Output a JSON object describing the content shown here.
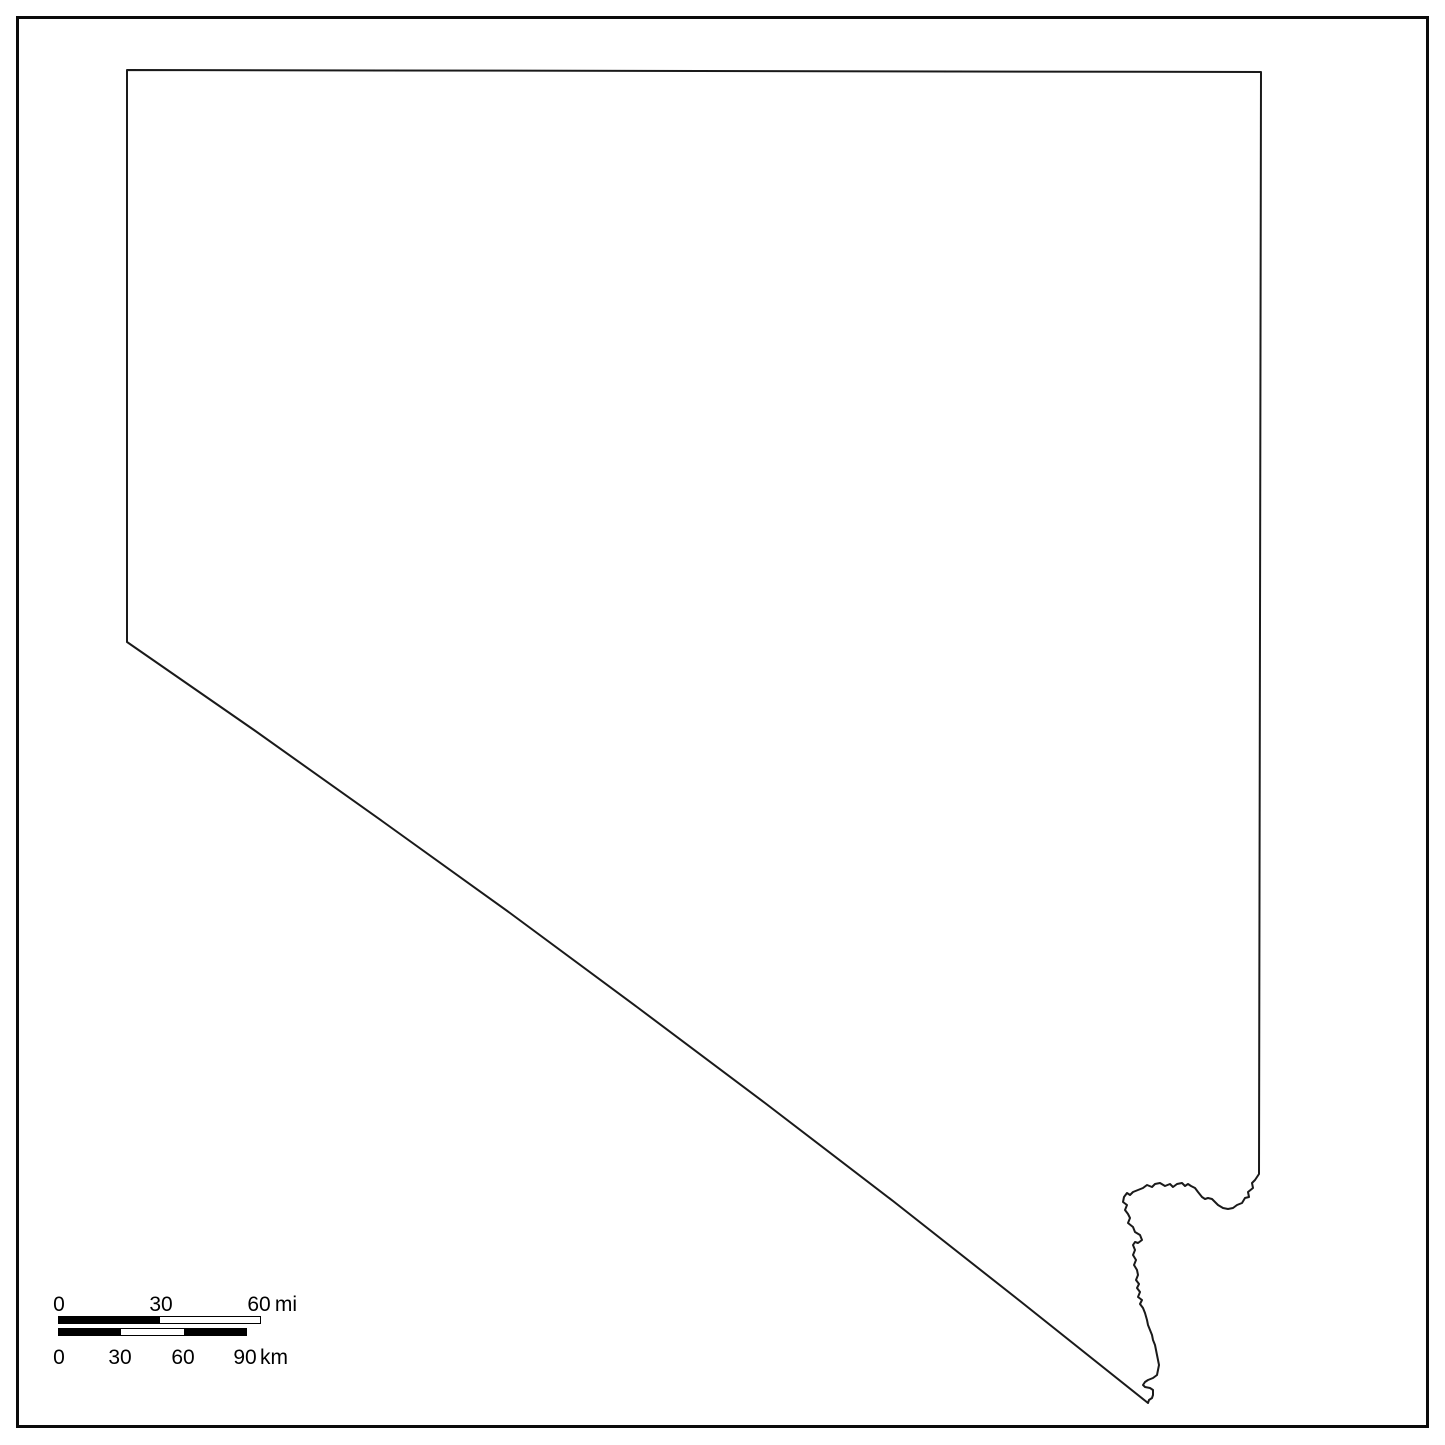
{
  "page": {
    "background_color": "#ffffff",
    "frame_color": "#0a0a0a"
  },
  "map": {
    "region": "Nevada",
    "description": "blank state outline map",
    "stroke_color": "#1a1a1a",
    "stroke_width": 2,
    "outline_points": [
      [
        127,
        70
      ],
      [
        1261,
        72
      ],
      [
        1259,
        1174
      ],
      [
        1255,
        1180
      ],
      [
        1252,
        1183
      ],
      [
        1253,
        1188
      ],
      [
        1248,
        1192
      ],
      [
        1249,
        1197
      ],
      [
        1245,
        1198
      ],
      [
        1242,
        1203
      ],
      [
        1237,
        1205
      ],
      [
        1233,
        1208
      ],
      [
        1228,
        1209
      ],
      [
        1223,
        1208
      ],
      [
        1218,
        1205
      ],
      [
        1212,
        1199
      ],
      [
        1208,
        1198
      ],
      [
        1205,
        1199
      ],
      [
        1202,
        1197
      ],
      [
        1198,
        1192
      ],
      [
        1195,
        1188
      ],
      [
        1191,
        1186
      ],
      [
        1188,
        1184
      ],
      [
        1185,
        1186
      ],
      [
        1182,
        1183
      ],
      [
        1177,
        1184
      ],
      [
        1173,
        1187
      ],
      [
        1170,
        1184
      ],
      [
        1165,
        1186
      ],
      [
        1160,
        1183
      ],
      [
        1155,
        1184
      ],
      [
        1152,
        1187
      ],
      [
        1147,
        1185
      ],
      [
        1143,
        1188
      ],
      [
        1138,
        1190
      ],
      [
        1133,
        1192
      ],
      [
        1130,
        1195
      ],
      [
        1127,
        1193
      ],
      [
        1124,
        1197
      ],
      [
        1123,
        1202
      ],
      [
        1127,
        1205
      ],
      [
        1125,
        1210
      ],
      [
        1128,
        1214
      ],
      [
        1130,
        1218
      ],
      [
        1128,
        1223
      ],
      [
        1133,
        1227
      ],
      [
        1135,
        1232
      ],
      [
        1140,
        1235
      ],
      [
        1142,
        1240
      ],
      [
        1138,
        1243
      ],
      [
        1135,
        1242
      ],
      [
        1133,
        1245
      ],
      [
        1135,
        1250
      ],
      [
        1133,
        1255
      ],
      [
        1136,
        1260
      ],
      [
        1134,
        1265
      ],
      [
        1137,
        1270
      ],
      [
        1138,
        1275
      ],
      [
        1136,
        1280
      ],
      [
        1139,
        1284
      ],
      [
        1137,
        1288
      ],
      [
        1140,
        1292
      ],
      [
        1138,
        1297
      ],
      [
        1142,
        1300
      ],
      [
        1140,
        1304
      ],
      [
        1143,
        1308
      ],
      [
        1145,
        1313
      ],
      [
        1147,
        1320
      ],
      [
        1148,
        1325
      ],
      [
        1150,
        1330
      ],
      [
        1152,
        1335
      ],
      [
        1153,
        1340
      ],
      [
        1155,
        1345
      ],
      [
        1156,
        1350
      ],
      [
        1157,
        1355
      ],
      [
        1158,
        1360
      ],
      [
        1159,
        1365
      ],
      [
        1158,
        1370
      ],
      [
        1157,
        1375
      ],
      [
        1153,
        1378
      ],
      [
        1148,
        1380
      ],
      [
        1145,
        1382
      ],
      [
        1143,
        1385
      ],
      [
        1145,
        1387
      ],
      [
        1150,
        1388
      ],
      [
        1153,
        1390
      ],
      [
        1153,
        1395
      ],
      [
        1152,
        1398
      ],
      [
        1149,
        1400
      ],
      [
        1148,
        1403
      ],
      [
        1020,
        1301
      ],
      [
        893,
        1201
      ],
      [
        765,
        1103
      ],
      [
        637,
        1007
      ],
      [
        510,
        913
      ],
      [
        382,
        821
      ],
      [
        254,
        730
      ],
      [
        127,
        642
      ]
    ]
  },
  "scale_bar": {
    "miles": {
      "ticks": [
        "0",
        "30",
        "60"
      ],
      "unit": "mi"
    },
    "kilometers": {
      "ticks": [
        "0",
        "30",
        "60",
        "90"
      ],
      "unit": "km"
    },
    "colors": {
      "dark": "#000000",
      "light": "#ffffff"
    }
  }
}
